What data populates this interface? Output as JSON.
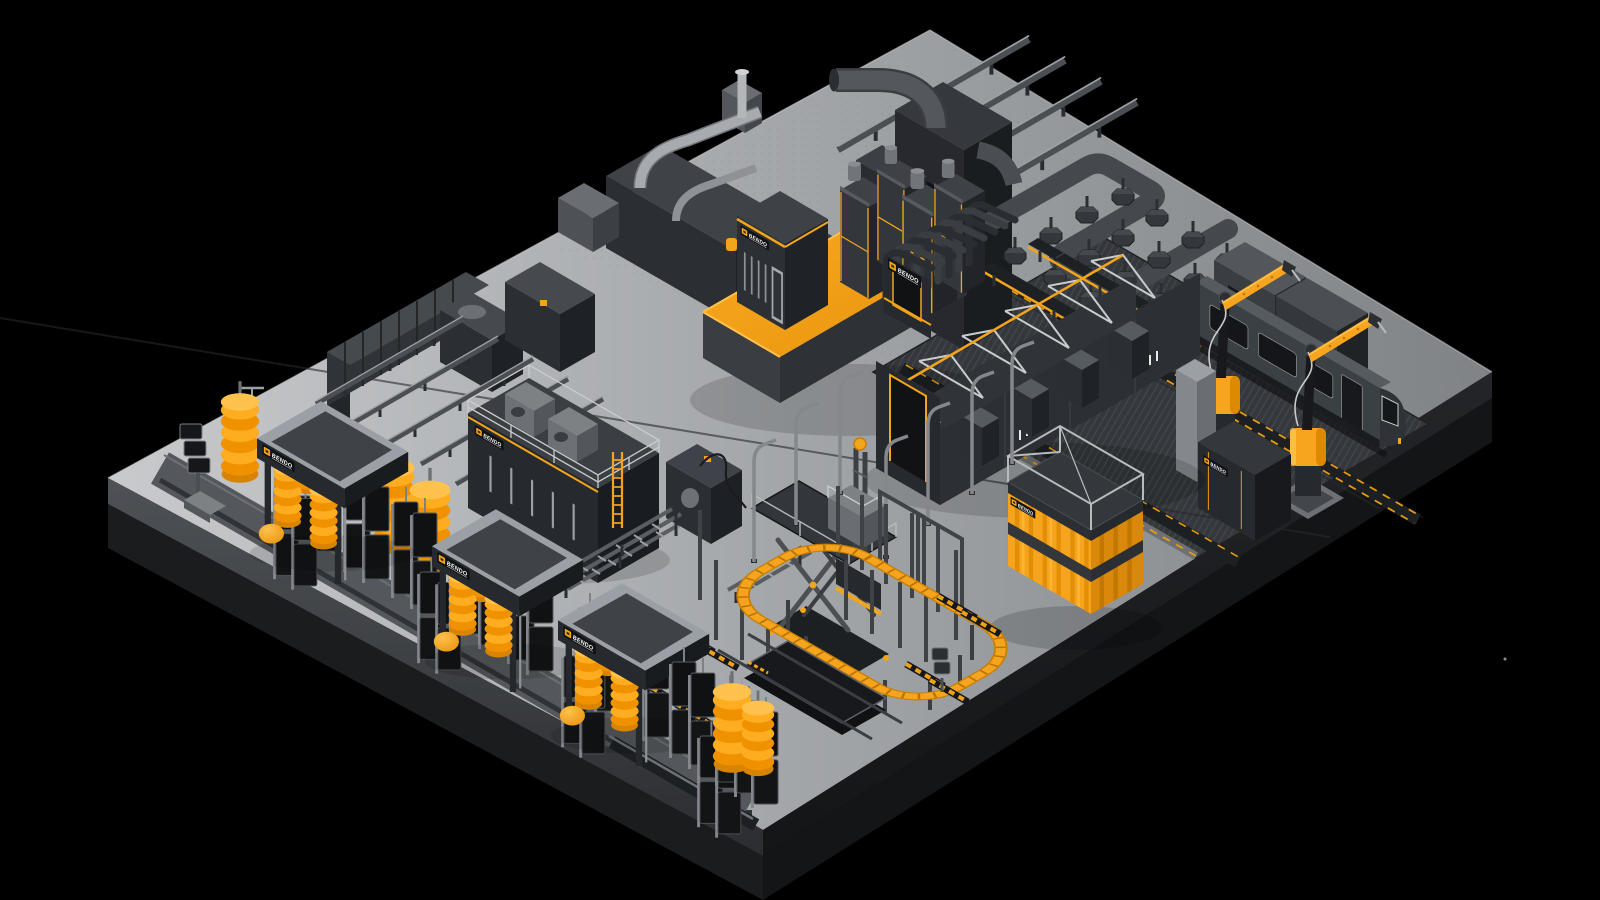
{
  "scene": {
    "description": "Isometric illustration of a BENDO industrial wash-equipment factory floor",
    "background_color": "#000000",
    "accent_color": "#F6A41D",
    "accent_color_bright": "#FFB637",
    "accent_color_deep": "#D98A00",
    "machine_dark": "#26292D",
    "machine_mid": "#34383D",
    "steel_light": "#B9BDC0",
    "floor_light": "#C8CACC",
    "floor_dark": "#7F8386"
  },
  "brand": {
    "name": "BENDO"
  },
  "equipment": [
    "wash-gantry-icon",
    "rotating-brush-icon",
    "side-panel-icon",
    "robot-arm-icon",
    "tram-icon",
    "truss-tunnel-icon",
    "bellows-cover-icon",
    "filter-platform-icon",
    "control-cabin-icon",
    "duct-tower-icon",
    "overhead-conveyor-icon",
    "hex-nozzle-icon",
    "belt-conveyor-icon",
    "roller-conveyor-icon",
    "scissor-lift-icon",
    "order-picker-icon",
    "loop-conveyor-icon",
    "curtain-container-icon",
    "mezzanine-enclosure-icon",
    "operator-kiosk-icon",
    "weighbridge-icon",
    "hazard-marking-icon",
    "service-pit-icon",
    "pipe-run-icon",
    "spray-lance-icon",
    "storage-rack-icon"
  ]
}
